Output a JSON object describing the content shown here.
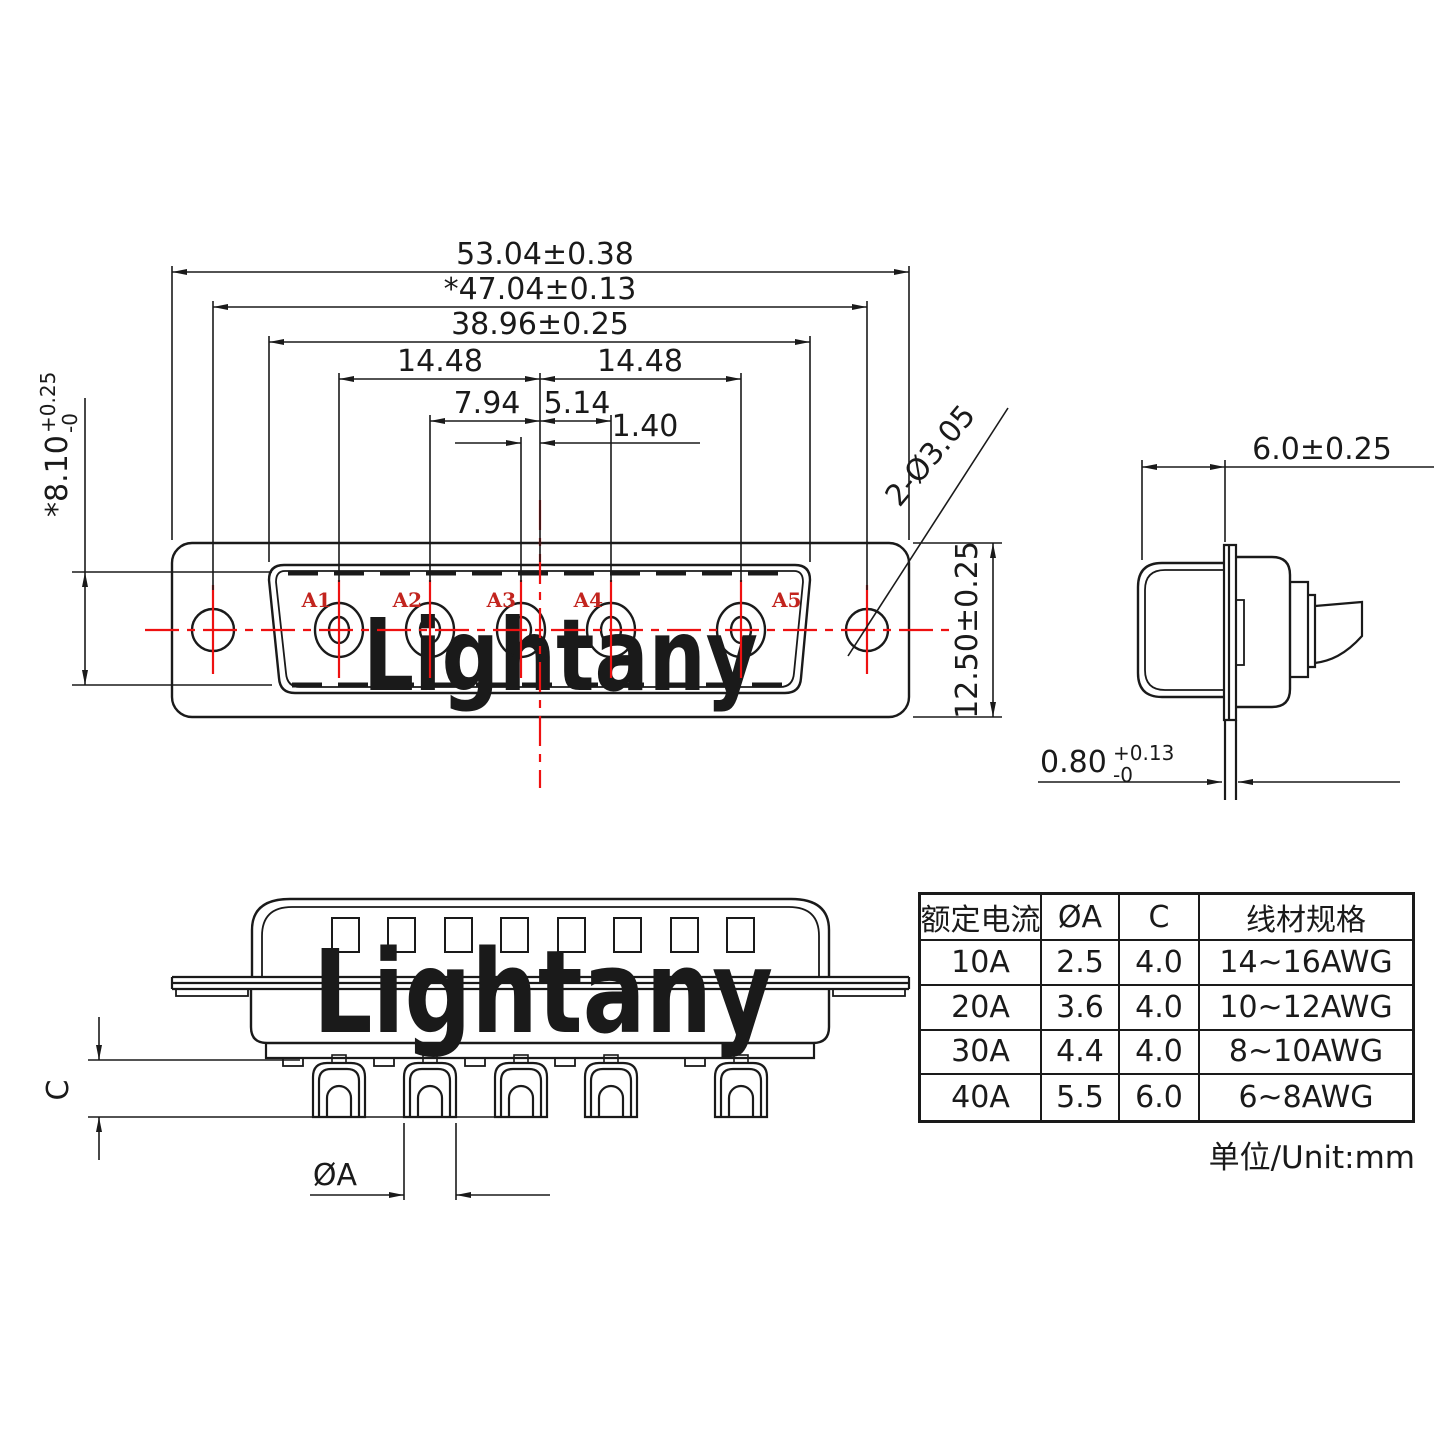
{
  "front": {
    "dim53": "53.04±0.38",
    "dim47": "*47.04±0.13",
    "dim3896": "38.96±0.25",
    "dim1448a": "14.48",
    "dim1448b": "14.48",
    "dim794": "7.94",
    "dim514": "5.14",
    "dim140": "1.40",
    "dim810": {
      "main": "*8.10",
      "tol_up": "+0.25",
      "tol_dn": "-0"
    },
    "dim1250": "12.50±0.25",
    "holes_note": "2-Ø3.05",
    "pins": [
      "A1",
      "A2",
      "A3",
      "A4",
      "A5"
    ]
  },
  "side": {
    "dim60": "6.0±0.25",
    "dim080": {
      "main": "0.80",
      "tol_up": "+0.13",
      "tol_dn": "-0"
    }
  },
  "bottom": {
    "dimC": "C",
    "dimA": "ØA"
  },
  "table": {
    "headers": [
      "额定电流",
      "ØA",
      "C",
      "线材规格"
    ],
    "rows": [
      [
        "10A",
        "2.5",
        "4.0",
        "14~16AWG"
      ],
      [
        "20A",
        "3.6",
        "4.0",
        "10~12AWG"
      ],
      [
        "30A",
        "4.4",
        "4.0",
        "8~10AWG"
      ],
      [
        "40A",
        "5.5",
        "6.0",
        "6~8AWG"
      ]
    ],
    "unit": "单位/Unit:mm"
  },
  "watermark": {
    "text": "Lightany"
  },
  "colors": {
    "line": "#1a1a1a",
    "red": "#ee1111",
    "label_red": "#c2241e",
    "watermark": "#f3cdcd"
  }
}
